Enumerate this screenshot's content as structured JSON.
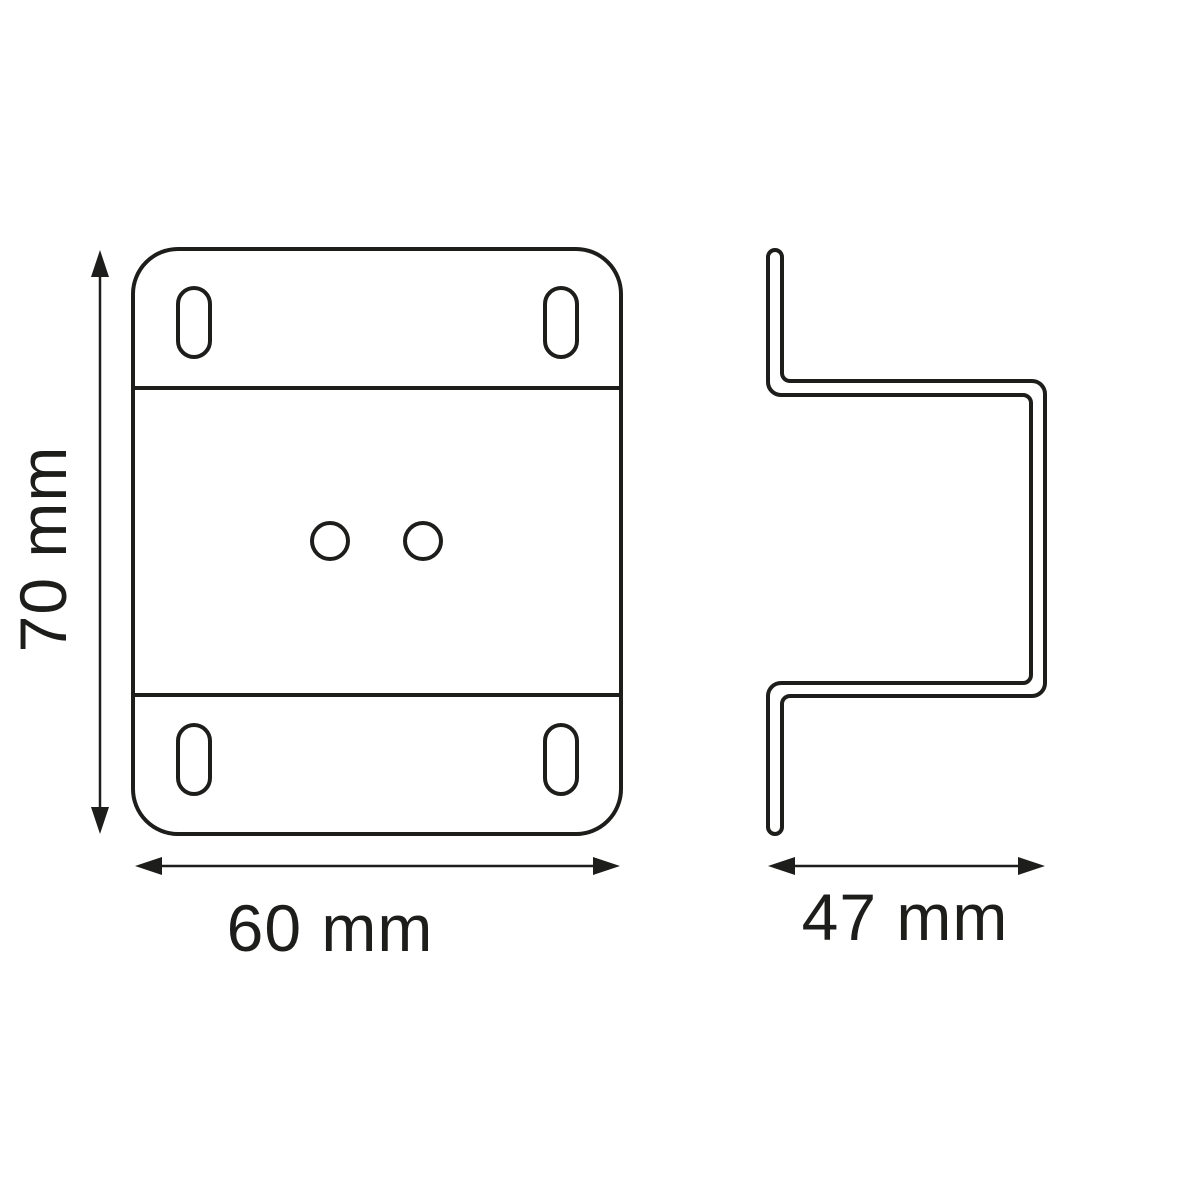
{
  "diagram": {
    "type": "technical-drawing",
    "background_color": "#ffffff",
    "line_color": "#1d1d1b",
    "front_view": {
      "height_label": "70 mm",
      "width_label": "60 mm",
      "slot_hole_count": 4,
      "round_hole_count": 2
    },
    "side_view": {
      "depth_label": "47 mm"
    }
  }
}
